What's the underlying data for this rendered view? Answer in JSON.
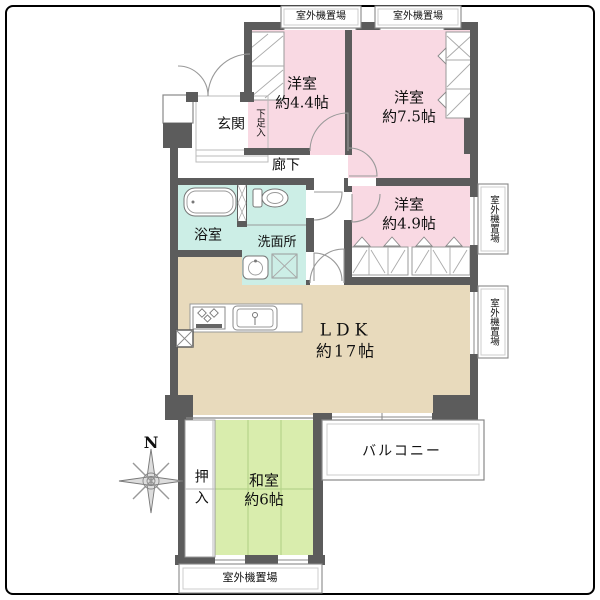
{
  "rooms": {
    "western_44": {
      "name": "洋室",
      "size": "約4.4帖"
    },
    "western_75": {
      "name": "洋室",
      "size": "約7.5帖"
    },
    "western_49": {
      "name": "洋室",
      "size": "約4.9帖"
    },
    "ldk": {
      "name": "LDK",
      "size": "約17帖"
    },
    "japanese": {
      "name": "和室",
      "size": "約6帖"
    },
    "entrance": {
      "label": "玄関"
    },
    "shoe_cupboard": {
      "label": "下足入"
    },
    "hallway": {
      "label": "廊下"
    },
    "bathroom": {
      "label": "浴室"
    },
    "washroom": {
      "label": "洗面所"
    },
    "futon_closet": {
      "label": "押入"
    },
    "balcony": {
      "label": "バルコニー"
    }
  },
  "outdoor_units": {
    "top_left": "室外機置場",
    "top_right": "室外機置場",
    "right_upper": "室外機置場",
    "right_lower": "室外機置場",
    "bottom": "室外機置場"
  },
  "compass": {
    "north": "N"
  },
  "colors": {
    "western_room": "#f9d9e3",
    "water_area": "#cceee6",
    "ldk": "#e8dabc",
    "japanese_room": "#d9edad",
    "wall": "#5c5c5c",
    "thin_line": "#999999"
  }
}
